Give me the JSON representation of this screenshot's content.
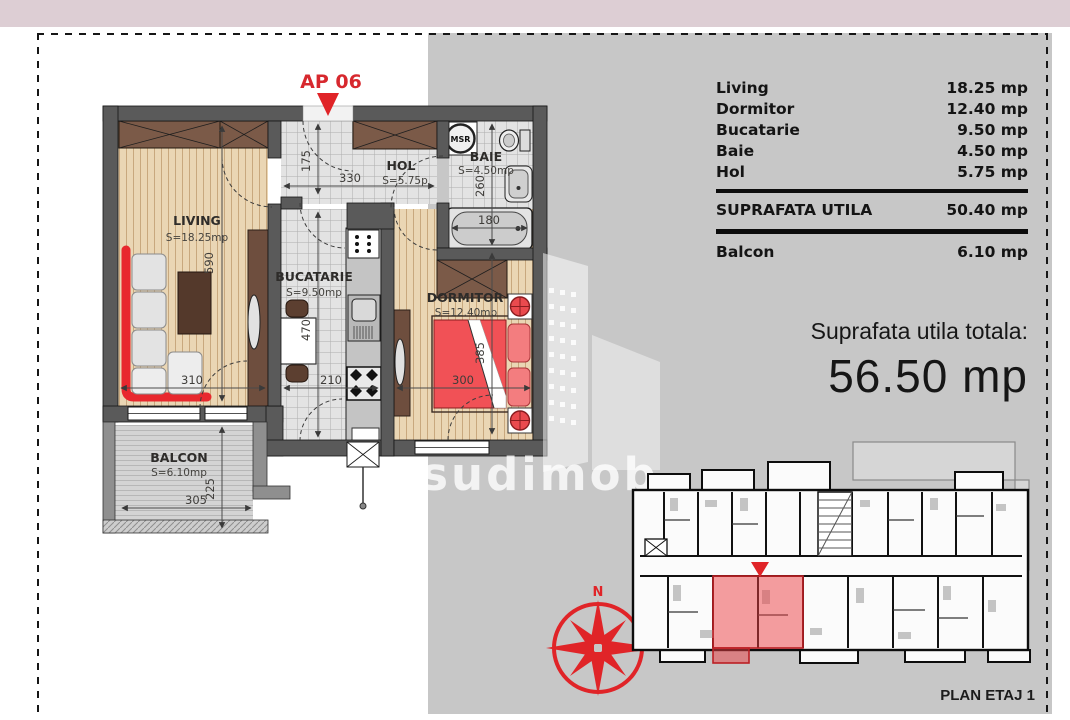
{
  "header": {
    "left_title": "ETAJ 1",
    "right_title": "AP. 06 - 2 CAMERE"
  },
  "area_table": {
    "rows": [
      {
        "label": "Living",
        "value": "18.25 mp"
      },
      {
        "label": "Dormitor",
        "value": "12.40 mp"
      },
      {
        "label": "Bucatarie",
        "value": "9.50 mp"
      },
      {
        "label": "Baie",
        "value": "4.50 mp"
      },
      {
        "label": "Hol",
        "value": "5.75 mp"
      }
    ],
    "total": {
      "label": "SUPRAFATA UTILA",
      "value": "50.40 mp"
    },
    "balcony": {
      "label": "Balcon",
      "value": "6.10 mp"
    }
  },
  "summary": {
    "label": "Suprafata utila totala:",
    "value": "56.50 mp"
  },
  "floorplan": {
    "apartment_tag": "AP 06",
    "rooms": [
      {
        "name": "LIVING",
        "area": "S=18.25mp"
      },
      {
        "name": "HOL",
        "area": "S=5.75p"
      },
      {
        "name": "BAIE",
        "area": "S=4.50mp"
      },
      {
        "name": "BUCATARIE",
        "area": "S=9.50mp"
      },
      {
        "name": "DORMITOR",
        "area": "S=12.40mp"
      },
      {
        "name": "BALCON",
        "area": "S=6.10mp"
      }
    ],
    "dims": {
      "living_height": "590",
      "living_width": "310",
      "hall_depth": "175",
      "hall_width": "330",
      "bath_height": "260",
      "tub_width": "180",
      "kitchen_height": "470",
      "kitchen_width": "210",
      "bedroom_height": "385",
      "bedroom_width": "300",
      "balcony_height": "225",
      "balcony_width": "305"
    },
    "washer_label": "MSR",
    "compass_north": "N"
  },
  "overview": {
    "caption": "PLAN ETAJ 1"
  },
  "watermark": {
    "text": "sudimob"
  },
  "colors": {
    "accent_red": "#e02428",
    "header_pink": "#ddced4",
    "panel_gray": "#c7c7c7",
    "wall_gray": "#5a5a5a",
    "wood": "#ead6b4"
  }
}
